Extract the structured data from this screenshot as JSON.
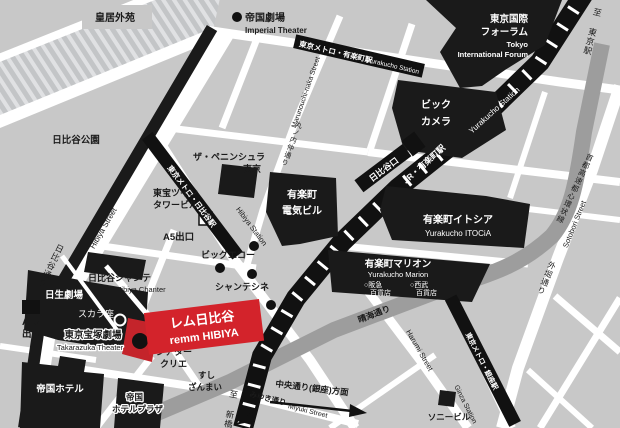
{
  "colors": {
    "background": "#c8c8c8",
    "street": "#ffffff",
    "building": "#1a1a1a",
    "expressway_band": "#9d9d9d",
    "accent_red": "#d3232b",
    "hatch_stripe": "#e0e1e3"
  },
  "areas": {
    "imperial_palace_garden": "皇居外苑",
    "hibiya_park": "日比谷公園"
  },
  "landmarks": {
    "imperial_theater": {
      "jp": "帝国劇場",
      "en": "Imperial Theater"
    },
    "tokyo_international_forum": {
      "jp1": "東京国際",
      "jp2": "フォーラム",
      "en1": "Tokyo",
      "en2": "International Forum"
    },
    "bic_camera": {
      "l1": "ビック",
      "l2": "カメラ"
    },
    "peninsula": {
      "l1": "ザ・ペニンシュラ",
      "l2": "東京"
    },
    "denki_building": {
      "l1": "有楽町",
      "l2": "電気ビル"
    },
    "toho_twin_tower": {
      "l1": "東宝ツイン",
      "l2": "タワービル"
    },
    "itocia": {
      "jp": "有楽町イトシア",
      "en": "Yurakucho ITOCiA"
    },
    "marion": {
      "jp": "有楽町マリオン",
      "en": "Yurakucho Marion",
      "hankyu1": "○阪急",
      "hankyu2": "百貨店",
      "seibu1": "○西武",
      "seibu2": "百貨店"
    },
    "big_echo": "ビッグエコー",
    "chante_cine": "シャンテシネ",
    "hibiya_chanter": {
      "jp": "日比谷シャンテ",
      "en": "Hibiya Chanter"
    },
    "nissay_theatre": "日生劇場",
    "scala_za": "スカラ座",
    "takarazuka": {
      "jp": "東京宝塚劇場",
      "en": "Takarazuka Theater"
    },
    "theatre_creation": {
      "l1": "シアター",
      "l2": "クリエ"
    },
    "sushi_zanmai": {
      "l1": "すし",
      "l2": "ざんまい"
    },
    "imperial_hotel": "帝国ホテル",
    "imperial_hotel_plaza": {
      "l1": "帝国",
      "l2": "ホテルプラザ"
    },
    "sony_building": "ソニービル",
    "remm_hibiya": {
      "jp": "レム日比谷",
      "en": "remm HIBIYA"
    }
  },
  "transit": {
    "metro_yurakucho": {
      "jp": "東京メトロ・有楽町駅",
      "en": "Yurakucho Station"
    },
    "jr_yurakucho": {
      "jp": "JR・有楽町駅",
      "en": "Yurakucho Station"
    },
    "metro_hibiya": {
      "jp": "東京メトロ・日比谷駅",
      "en": "Hibiya Station"
    },
    "metro_ginza": {
      "jp": "東京メトロ・銀座駅",
      "en": "Ginza Station"
    },
    "hibiya_exit": "日比谷口",
    "exit_a5": "A5出口",
    "exit_a13": {
      "l1": "A13",
      "l2": "出口"
    },
    "to_tokyo_station": "至 東京駅",
    "to_shimbashi": "至 新橋"
  },
  "streets": {
    "hibiya_dori": "日比谷通り",
    "hibiya_street_en": "Hibiya Street",
    "marunouchi_naka_jp": "丸ノ内仲通り",
    "marunouchi_naka_en": "Marunouchi-naka Street",
    "harumi_dori": "晴海通り",
    "harumi_street_en": "Harumi Street",
    "sotobori_dori": "外堀通り",
    "sotobori_street_en": "Sotobori Street",
    "shuto_expressway": "首都高速都心環状線",
    "miyuki_dori": "みゆき通り",
    "miyuki_street_en": "Miyuki Street",
    "chuo_dori_direction": "中央通り(銀座)方面"
  }
}
